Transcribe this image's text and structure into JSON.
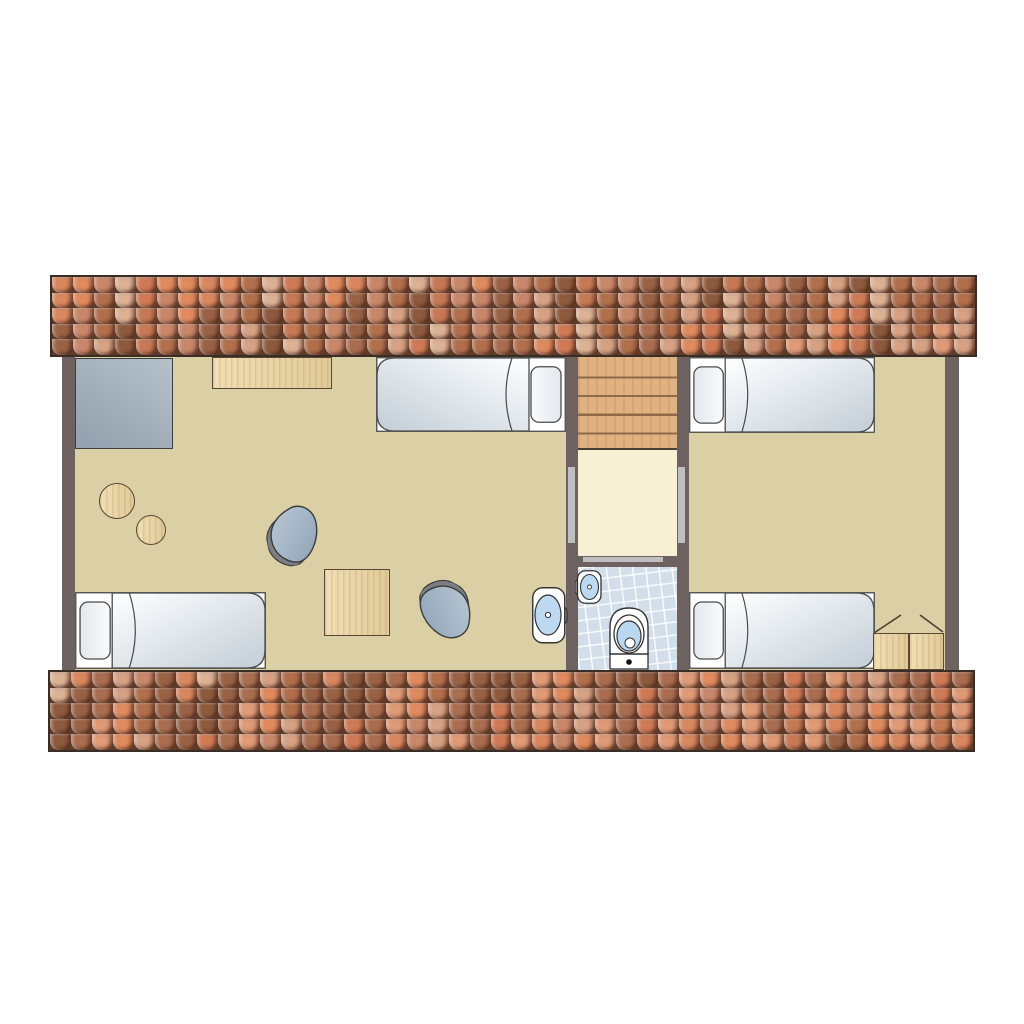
{
  "title": "Attic floor plan with two bedrooms, stair hall and bathroom",
  "colors": {
    "white": "#ffffff",
    "outline": "#4a4a4a",
    "floor": "#dbd0a5",
    "landing": "#f8f0d5",
    "wall": "#6e6260",
    "doorStrip": "#bfbfc1",
    "stairs": "#e0b181",
    "stairLine": "#8d6b49",
    "wood": "#ecd5a0",
    "woodDark": "#5a4632",
    "wardrobe1": "#b6c1ca",
    "wardrobe2": "#94a3af",
    "tileBlue": "#d2deea",
    "fixtureBlue": "#bcd9ef",
    "toiletBlue": "#b9d8f0",
    "tapGray": "#8a8a8a",
    "beanShadow": "#7c7e81",
    "roofBg": "#5e3a28",
    "roofBorder": "#3a2d26",
    "mattressLight": "#fbfdfe",
    "mattressDark": "#c6d0d8",
    "pillowLight": "#f9fbfc",
    "pillowDark": "#e3e8ec"
  },
  "roof": {
    "rows": 5,
    "cols": 44,
    "palette": [
      "#d9875f",
      "#b26f4c",
      "#8e5a3e",
      "#e09a76",
      "#c9876a",
      "#ddb294",
      "#aa6d4f",
      "#e08a5e",
      "#c67954",
      "#9a6245",
      "#d7a284",
      "#cf7a55"
    ]
  },
  "rooms": [
    {
      "name": "left bedroom"
    },
    {
      "name": "stair hall"
    },
    {
      "name": "bathroom"
    },
    {
      "name": "right bedroom"
    }
  ],
  "furniture_inventory": {
    "single_beds": 4,
    "wardrobe": 1,
    "desk": 1,
    "square_table": 1,
    "round_stools": 2,
    "bean_bag_chairs": 2,
    "two_door_cabinet": 1,
    "staircase_treads": 5,
    "toilet": 1,
    "washbasins": 2
  }
}
